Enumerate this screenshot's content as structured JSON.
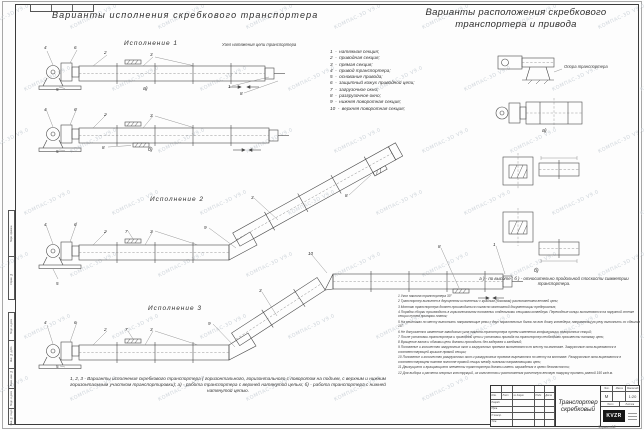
{
  "titles": {
    "left": "Варианты исполнения скребкового транспортера",
    "right": "Варианты расположения скребкового транспортера и привода"
  },
  "labels": {
    "exec1": "Исполнение  1",
    "exec2": "Исполнение  2",
    "exec3": "Исполнение  3",
    "variant_a": "а)",
    "variant_b": "б)",
    "tension_unit": "Узел натяжения цепи транспортера",
    "support": "Опора транспортера",
    "ab_note": "а ) -  по высоте ;  б ) -  относительно продольной плоскости симметрии транспортера.",
    "caption": "1, 2, 3 -  Варианты исполнения скребкового транспортера ( горизонтального, горизонтального с поворотом на подъем, с верхним и нижним горизонтальным участком транспортировки);  а) -  работа транспортера с верхней натянутой цепью;  б) -  работа транспортера с нижней натянутой цепью."
  },
  "legend": {
    "dash": "-",
    "items": [
      {
        "num": "1",
        "text": "натяжная секция;"
      },
      {
        "num": "2",
        "text": "приводная секция;"
      },
      {
        "num": "3",
        "text": "прямая секция;"
      },
      {
        "num": "4",
        "text": "привод транспортера;"
      },
      {
        "num": "5",
        "text": "основание привода;"
      },
      {
        "num": "6",
        "text": "защитный кожух приводной цепи;"
      },
      {
        "num": "7",
        "text": "загрузочное окно;"
      },
      {
        "num": "8",
        "text": "разгрузочное окно;"
      },
      {
        "num": "9",
        "text": "нижняя поворотная секция;"
      },
      {
        "num": "10",
        "text": "верхняя поворотная секция;"
      }
    ]
  },
  "notes": [
    "1  Угол наклона транспортера  30°",
    "2  Транспортер выполнен в двухцепном исполнении с крайним (боковым) расположением ветвей цепи;",
    "3  Монтаж транспортера должен производиться согласно монтажной документации предприятия;",
    "4  Порядок сборки производить в горизонтальном положении отдельными секциями конвейера. Переходные концы выполняются на наружной стенке секции путем приварки планок;",
    "5  На рештаках по месту выполнить направляющие резы с двух параллельных балок на всю длину конвейера; направляющую резу выполнить со сдвигом  15°",
    "6  Не допускается изменение заводского угла наклона транспортера путем изменения конфигурации поворотных секций;",
    "7  После установки транспортера и приводной цепи и установки привода на транспортер необходимо произвести натяжку цепи;",
    "8  Вращение валов и обжимы цепи должны проходить без задержек и заеданий;",
    "9  Положение и количество загрузочных окон и загрузочных проемов выполняются по месту на монтаже. Загрузочные окна вырезаются в соответствующей крышке прямой секции;",
    "10  Положение и количество разгрузочных окон и разгрузочных проемов вырезаются по месту на монтаже. Разгрузочные окна вырезаются в соответствующем нижнем полотне прямой секции между нижними направляющими цепи;",
    "11  Движущиеся и вращающиеся элементы транспортера должны иметь ограждения в целях безопасности;",
    "12  Для выбора и расчета опорных конструкций, их количества и расположения расчетную весовую нагрузку принять равной  150 кг/п.м."
  ],
  "title_block": {
    "doc_name": "Транспортер скребковый",
    "header_cells": [
      "Изм.",
      "Лист",
      "№ докум.",
      "Подп.",
      "Дата"
    ],
    "roles": [
      "Разраб.",
      "Пров.",
      "Н.контр.",
      "Утв."
    ],
    "lit_header": "Лит.",
    "mass_header": "Масса",
    "scale_header": "Масштаб",
    "litera": "М",
    "scale": "1:20",
    "sheet_header": "Лист",
    "sheets_header": "Листов",
    "logo": "KVZR",
    "format": "Формат  А3"
  },
  "frame": {
    "side_labels_upper": [
      "Перв. примен.",
      "Справ. №"
    ],
    "side_labels_lower": [
      "Подп. и дата",
      "Инв. № дубл.",
      "Взам. инв. №",
      "Подп. и дата",
      "Инв. № подл."
    ]
  },
  "watermark": {
    "text": "КОМПАС-3D V9.0",
    "color": "#cfd5db"
  }
}
